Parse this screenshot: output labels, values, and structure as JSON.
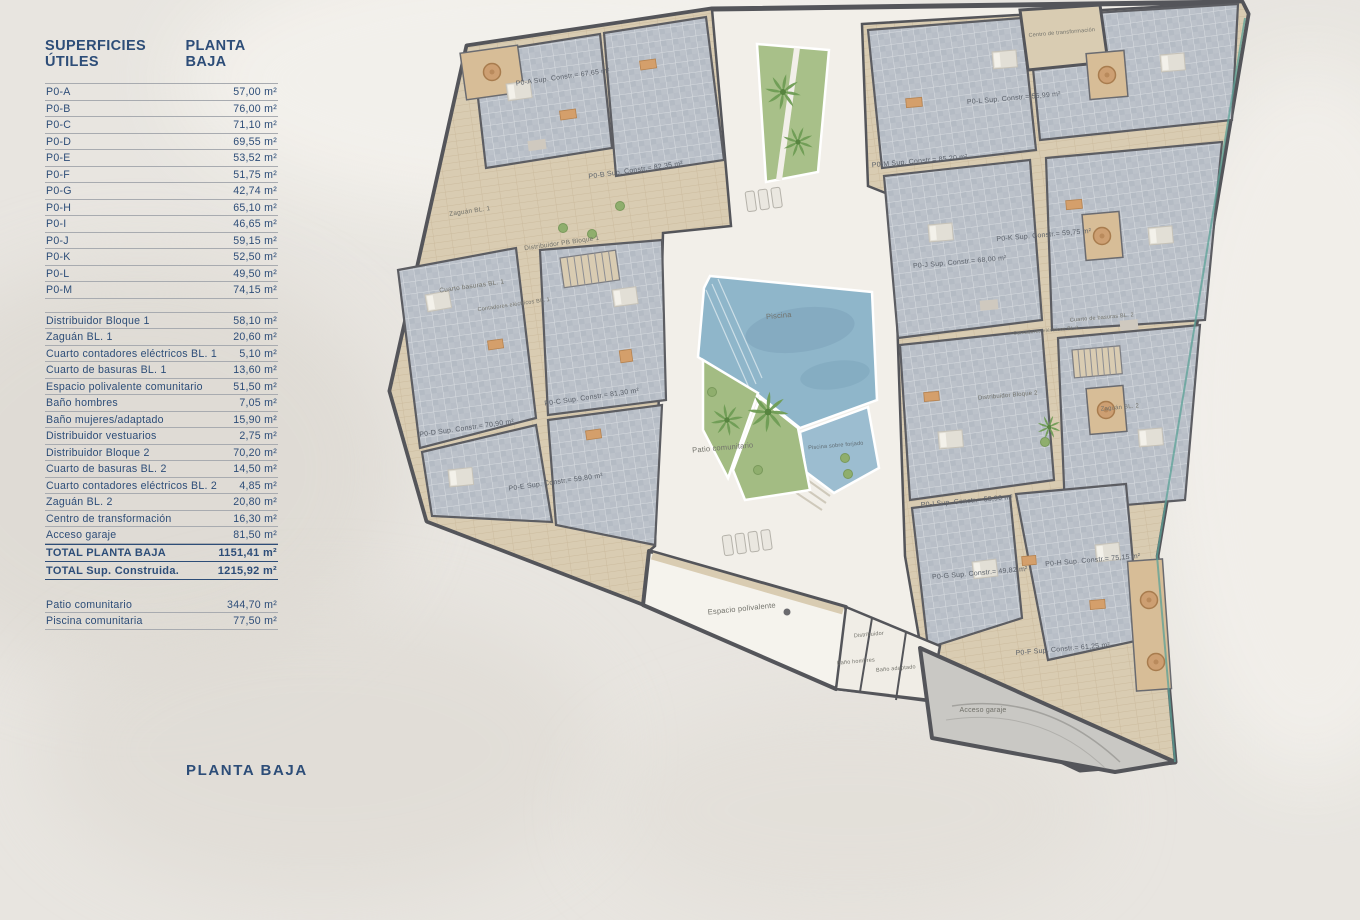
{
  "panel": {
    "title_left": "SUPERFICIES ÚTILES",
    "title_right": "PLANTA BAJA",
    "unit_rows": [
      {
        "label": "P0-A",
        "value": "57,00 m²"
      },
      {
        "label": "P0-B",
        "value": "76,00 m²"
      },
      {
        "label": "P0-C",
        "value": "71,10 m²"
      },
      {
        "label": "P0-D",
        "value": "69,55 m²"
      },
      {
        "label": "P0-E",
        "value": "53,52 m²"
      },
      {
        "label": "P0-F",
        "value": "51,75 m²"
      },
      {
        "label": "P0-G",
        "value": "42,74 m²"
      },
      {
        "label": "P0-H",
        "value": "65,10 m²"
      },
      {
        "label": "P0-I",
        "value": "46,65 m²"
      },
      {
        "label": "P0-J",
        "value": "59,15 m²"
      },
      {
        "label": "P0-K",
        "value": "52,50 m²"
      },
      {
        "label": "P0-L",
        "value": "49,50 m²"
      },
      {
        "label": "P0-M",
        "value": "74,15 m²"
      }
    ],
    "common_rows": [
      {
        "label": "Distribuidor Bloque 1",
        "value": "58,10 m²"
      },
      {
        "label": "Zaguán BL. 1",
        "value": "20,60 m²"
      },
      {
        "label": "Cuarto contadores eléctricos BL. 1",
        "value": "5,10 m²"
      },
      {
        "label": "Cuarto de basuras BL. 1",
        "value": "13,60 m²"
      },
      {
        "label": "Espacio polivalente comunitario",
        "value": "51,50 m²"
      },
      {
        "label": "Baño hombres",
        "value": "7,05 m²"
      },
      {
        "label": "Baño mujeres/adaptado",
        "value": "15,90 m²"
      },
      {
        "label": "Distribuidor vestuarios",
        "value": "2,75 m²"
      },
      {
        "label": "Distribuidor Bloque 2",
        "value": "70,20 m²"
      },
      {
        "label": "Cuarto de basuras BL. 2",
        "value": "14,50 m²"
      },
      {
        "label": "Cuarto contadores eléctricos BL. 2",
        "value": "4,85 m²"
      },
      {
        "label": "Zaguán BL. 2",
        "value": "20,80 m²"
      },
      {
        "label": "Centro de transformación",
        "value": "16,30 m²"
      },
      {
        "label": "Acceso garaje",
        "value": "81,50 m²"
      }
    ],
    "total_rows": {
      "planta": {
        "label": "TOTAL PLANTA BAJA",
        "value": "1151,41 m²"
      },
      "construida": {
        "label": "TOTAL Sup. Construida.",
        "value": "1215,92 m²"
      }
    },
    "outdoor_rows": [
      {
        "label": "Patio comunitario",
        "value": "344,70 m²"
      },
      {
        "label": "Piscina comunitaria",
        "value": "77,50 m²"
      }
    ]
  },
  "footer": {
    "caption": "PLANTA BAJA"
  },
  "plan": {
    "apartments": [
      {
        "code": "P0-A",
        "label": "P0-A Sup. Constr.= 67,65 m²"
      },
      {
        "code": "P0-B",
        "label": "P0-B Sup. Constr.= 82,35 m²"
      },
      {
        "code": "P0-C",
        "label": "P0-C Sup. Constr.= 81,30 m²"
      },
      {
        "code": "P0-D",
        "label": "P0-D Sup. Constr.= 70,90 m²"
      },
      {
        "code": "P0-E",
        "label": "P0-E Sup. Constr.= 59,80 m²"
      },
      {
        "code": "P0-F",
        "label": "P0-F Sup. Constr.= 61,25 m²"
      },
      {
        "code": "P0-G",
        "label": "P0-G Sup. Constr.= 49,82 m²"
      },
      {
        "code": "P0-H",
        "label": "P0-H Sup. Constr.= 75,15 m²"
      },
      {
        "code": "P0-I",
        "label": "P0-I Sup. Constr.= 53,90 m²"
      },
      {
        "code": "P0-J",
        "label": "P0-J Sup. Constr.= 68,00 m²"
      },
      {
        "code": "P0-K",
        "label": "P0-K Sup. Constr.= 59,75 m²"
      },
      {
        "code": "P0-L",
        "label": "P0-L Sup. Constr.= 55,99 m²"
      },
      {
        "code": "P0-M",
        "label": "P0-M Sup. Constr.= 85,20 m²"
      }
    ],
    "rooms": {
      "zaguan_bl1": "Zaguán BL. 1",
      "distribuidor_pb_bloque1": "Distribuidor PB Bloque 1",
      "cuarto_basuras_bl1": "Cuarto basuras BL. 1",
      "contadores_bl1": "Contadores eléctricos BL. 1",
      "piscina": "Piscina",
      "patio_comunitario": "Patio comunitario",
      "piscina_sobre": "Piscina sobre forjado",
      "espacio_polivalente": "Espacio polivalente",
      "distribuidor": "Distribuidor",
      "bano_hombres": "Baño hombres",
      "bano_adaptado": "Baño adaptado",
      "acceso_garaje": "Acceso garaje",
      "centro_transformacion": "Centro de transformación",
      "cuarto_basuras_bl2": "Cuarto de basuras BL. 2",
      "contadores_bl2": "Contadores eléctricos BL.2",
      "distribuidor_bloque2": "Distribuidor Bloque 2",
      "zaguan_bl2": "Zaguán BL. 2"
    }
  },
  "colors": {
    "navy_text": "#2d4d78",
    "paper": "#e8e5e0",
    "corridor_tan": "#d9ccb2",
    "apartment_gray": "#bcc2ca",
    "wall_dark": "#54555a",
    "pool_blue": "#8fb6ca",
    "green_garden": "#a3bc83",
    "garage_gray": "#c9c8c4",
    "balcony_tan": "#d7bd97",
    "boundary_teal": "#5ba197"
  }
}
